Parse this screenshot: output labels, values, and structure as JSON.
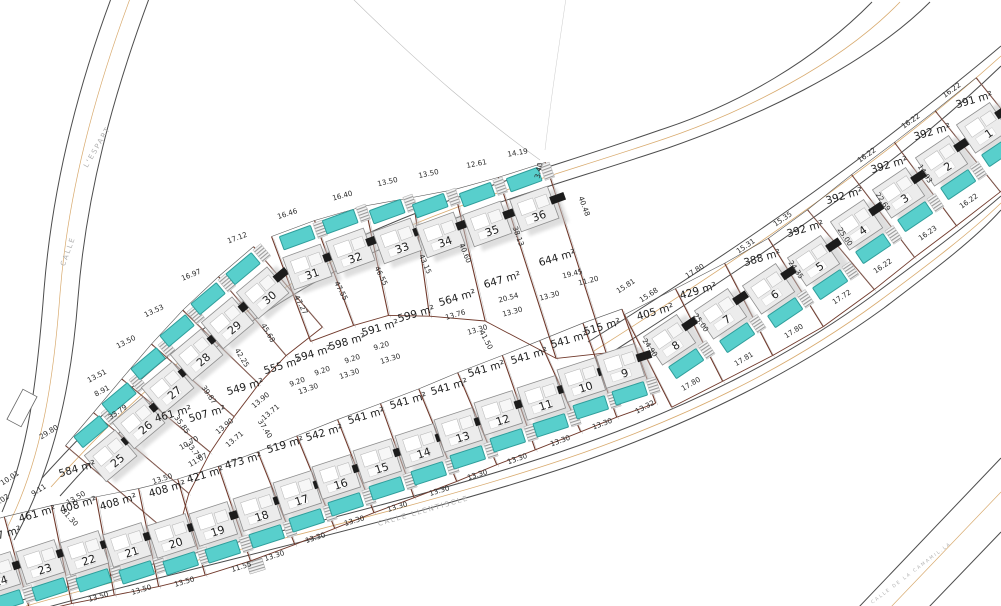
{
  "document": {
    "type": "urbanization plot site plan"
  },
  "streets": [
    {
      "id": "calle-l-espart",
      "words": [
        {
          "t": "CALLE",
          "x": 70,
          "y": 252,
          "r": -70
        },
        {
          "t": "L'ESPART",
          "x": 99,
          "y": 148,
          "r": -60
        }
      ]
    },
    {
      "id": "calle-llentiscle",
      "words": [
        {
          "t": "CALLE LLENTISCLE",
          "x": 424,
          "y": 513,
          "r": -16
        }
      ]
    },
    {
      "id": "calle-de-la-camamil-la",
      "words": [
        {
          "t": "CALLE DE LA CAMAMIL.LA",
          "x": 912,
          "y": 574,
          "r": -37
        }
      ]
    }
  ],
  "plots": [
    {
      "num": "1",
      "area": "391 m²",
      "nx": 982,
      "ny": 127,
      "ax": 975,
      "ay": 103
    },
    {
      "num": "2",
      "area": "392 m²",
      "nx": 941,
      "ny": 160,
      "ax": 933,
      "ay": 135
    },
    {
      "num": "3",
      "area": "392 m²",
      "nx": 898,
      "ny": 192,
      "ax": 890,
      "ay": 168
    },
    {
      "num": "4",
      "area": "392 m²",
      "nx": 856,
      "ny": 224,
      "ax": 845,
      "ay": 199
    },
    {
      "num": "5",
      "area": "392 m²",
      "nx": 813,
      "ny": 260,
      "ax": 806,
      "ay": 232
    },
    {
      "num": "6",
      "area": "388 m²",
      "nx": 768,
      "ny": 288,
      "ax": 763,
      "ay": 261
    },
    {
      "num": "7",
      "area": "429 m²",
      "nx": 720,
      "ny": 313,
      "ax": 699,
      "ay": 294
    },
    {
      "num": "8",
      "area": "405 m²",
      "nx": 669,
      "ny": 339,
      "ax": 656,
      "ay": 315
    },
    {
      "num": "9",
      "area": "515 m²",
      "nx": 620,
      "ny": 365,
      "ax": 603,
      "ay": 330
    },
    {
      "num": "10",
      "area": "541 m²",
      "nx": 581,
      "ny": 379,
      "ax": 570,
      "ay": 343
    },
    {
      "num": "11",
      "area": "541 m²",
      "nx": 541,
      "ny": 397,
      "ax": 530,
      "ay": 359
    },
    {
      "num": "12",
      "area": "541 m²",
      "nx": 498,
      "ny": 412,
      "ax": 487,
      "ay": 372
    },
    {
      "num": "13",
      "area": "541 m²",
      "nx": 458,
      "ny": 429,
      "ax": 450,
      "ay": 390
    },
    {
      "num": "14",
      "area": "541 m²",
      "nx": 419,
      "ny": 445,
      "ax": 409,
      "ay": 404
    },
    {
      "num": "15",
      "area": "541 m²",
      "nx": 377,
      "ny": 460,
      "ax": 367,
      "ay": 419
    },
    {
      "num": "16",
      "area": "542 m²",
      "nx": 336,
      "ny": 476,
      "ax": 325,
      "ay": 436
    },
    {
      "num": "17",
      "area": "519 m²",
      "nx": 297,
      "ny": 492,
      "ax": 286,
      "ay": 448
    },
    {
      "num": "18",
      "area": "473 m²",
      "nx": 257,
      "ny": 508,
      "ax": 244,
      "ay": 464
    },
    {
      "num": "19",
      "area": "421 m²",
      "nx": 213,
      "ny": 523,
      "ax": 206,
      "ay": 478
    },
    {
      "num": "20",
      "area": "408 m²",
      "nx": 171,
      "ny": 535,
      "ax": 168,
      "ay": 492
    },
    {
      "num": "21",
      "area": "408 m²",
      "nx": 127,
      "ny": 544,
      "ax": 119,
      "ay": 505
    },
    {
      "num": "22",
      "area": "408 m²",
      "nx": 84,
      "ny": 552,
      "ax": 79,
      "ay": 508
    },
    {
      "num": "23",
      "area": "461 m²",
      "nx": 40,
      "ny": 561,
      "ax": 38,
      "ay": 517
    },
    {
      "num": "24",
      "area": "7 m²",
      "nx": -4,
      "ny": 573,
      "ax": 10,
      "ay": 536
    },
    {
      "num": "25",
      "area": "584 m²",
      "nx": 110,
      "ny": 455,
      "ax": 78,
      "ay": 472
    },
    {
      "num": "26",
      "area": "461 m²",
      "nx": 138,
      "ny": 422,
      "ax": 174,
      "ay": 417
    },
    {
      "num": "27",
      "area": "507 m²",
      "nx": 167,
      "ny": 387,
      "ax": 208,
      "ay": 417
    },
    {
      "num": "28",
      "area": "549 m²",
      "nx": 196,
      "ny": 354,
      "ax": 246,
      "ay": 390
    },
    {
      "num": "29",
      "area": "555 m²",
      "nx": 227,
      "ny": 322,
      "ax": 283,
      "ay": 369
    },
    {
      "num": "30",
      "area": "594 m²",
      "nx": 262,
      "ny": 292,
      "ax": 314,
      "ay": 357
    },
    {
      "num": "31",
      "area": "598 m²",
      "nx": 307,
      "ny": 266,
      "ax": 348,
      "ay": 345
    },
    {
      "num": "32",
      "area": "591 m²",
      "nx": 350,
      "ny": 250,
      "ax": 381,
      "ay": 331
    },
    {
      "num": "33",
      "area": "599 m²",
      "nx": 397,
      "ny": 240,
      "ax": 417,
      "ay": 317
    },
    {
      "num": "34",
      "area": "564 m²",
      "nx": 440,
      "ny": 234,
      "ax": 458,
      "ay": 301
    },
    {
      "num": "35",
      "area": "647 m²",
      "nx": 487,
      "ny": 223,
      "ax": 503,
      "ay": 283
    },
    {
      "num": "36",
      "area": "644 m²",
      "nx": 534,
      "ny": 208,
      "ax": 558,
      "ay": 261
    }
  ],
  "dims": [
    {
      "t": "17.12",
      "x": 238,
      "y": 240,
      "r": -20
    },
    {
      "t": "16.46",
      "x": 288,
      "y": 216,
      "r": -18
    },
    {
      "t": "16.40",
      "x": 343,
      "y": 198,
      "r": -15
    },
    {
      "t": "13.50",
      "x": 388,
      "y": 184,
      "r": -13
    },
    {
      "t": "13.50",
      "x": 429,
      "y": 176,
      "r": -12
    },
    {
      "t": "12.61",
      "x": 477,
      "y": 166,
      "r": -11
    },
    {
      "t": "14.19",
      "x": 518,
      "y": 155,
      "r": -10
    },
    {
      "t": "3.40",
      "x": 541,
      "y": 171,
      "r": -78
    },
    {
      "t": "16.97",
      "x": 192,
      "y": 277,
      "r": -22
    },
    {
      "t": "13.53",
      "x": 155,
      "y": 313,
      "r": -25
    },
    {
      "t": "13.50",
      "x": 127,
      "y": 344,
      "r": -27
    },
    {
      "t": "13.51",
      "x": 98,
      "y": 378,
      "r": -28
    },
    {
      "t": "8.91",
      "x": 103,
      "y": 393,
      "r": -28
    },
    {
      "t": "33.79",
      "x": 119,
      "y": 414,
      "r": -34
    },
    {
      "t": "29.80",
      "x": 50,
      "y": 434,
      "r": -32
    },
    {
      "t": "10.01",
      "x": 11,
      "y": 480,
      "r": -33
    },
    {
      "t": "9.11",
      "x": 40,
      "y": 492,
      "r": -33
    },
    {
      "t": "9.02",
      "x": 3,
      "y": 502,
      "r": -33
    },
    {
      "t": "13.50",
      "x": 77,
      "y": 500,
      "r": -30
    },
    {
      "t": "13.50",
      "x": 163,
      "y": 481,
      "r": -18
    },
    {
      "t": "31.30",
      "x": 68,
      "y": 519,
      "r": 48
    },
    {
      "t": "11.55",
      "x": 242,
      "y": 569,
      "r": -17
    },
    {
      "t": "13.50",
      "x": 185,
      "y": 584,
      "r": -16
    },
    {
      "t": "13.50",
      "x": 142,
      "y": 592,
      "r": -16
    },
    {
      "t": "13.50",
      "x": 99,
      "y": 599,
      "r": -16
    },
    {
      "t": "47.27",
      "x": 299,
      "y": 306,
      "r": 62
    },
    {
      "t": "45.68",
      "x": 266,
      "y": 334,
      "r": 60
    },
    {
      "t": "42.25",
      "x": 240,
      "y": 359,
      "r": 58
    },
    {
      "t": "39.87",
      "x": 207,
      "y": 396,
      "r": 56
    },
    {
      "t": "35.85",
      "x": 180,
      "y": 426,
      "r": 54
    },
    {
      "t": "37.40",
      "x": 263,
      "y": 430,
      "r": 58
    },
    {
      "t": "13.90",
      "x": 262,
      "y": 402,
      "r": -40
    },
    {
      "t": "13.71",
      "x": 272,
      "y": 414,
      "r": -40
    },
    {
      "t": "13.90",
      "x": 226,
      "y": 428,
      "r": -40
    },
    {
      "t": "13.71",
      "x": 236,
      "y": 441,
      "r": -40
    },
    {
      "t": "33.79",
      "x": 192,
      "y": 452,
      "r": 52
    },
    {
      "t": "10.70",
      "x": 190,
      "y": 445,
      "r": -30
    },
    {
      "t": "11.07",
      "x": 199,
      "y": 462,
      "r": -30
    },
    {
      "t": "47.55",
      "x": 339,
      "y": 292,
      "r": 62
    },
    {
      "t": "46.55",
      "x": 379,
      "y": 277,
      "r": 64
    },
    {
      "t": "43.15",
      "x": 423,
      "y": 265,
      "r": 66
    },
    {
      "t": "40.60",
      "x": 463,
      "y": 254,
      "r": 68
    },
    {
      "t": "38.13",
      "x": 516,
      "y": 237,
      "r": 70
    },
    {
      "t": "40.48",
      "x": 582,
      "y": 207,
      "r": 70
    },
    {
      "t": "19.45",
      "x": 573,
      "y": 276,
      "r": -14
    },
    {
      "t": "11.20",
      "x": 589,
      "y": 283,
      "r": -14
    },
    {
      "t": "20.54",
      "x": 509,
      "y": 300,
      "r": -15
    },
    {
      "t": "13.76",
      "x": 456,
      "y": 317,
      "r": -16
    },
    {
      "t": "41.50",
      "x": 484,
      "y": 341,
      "r": 62
    },
    {
      "t": "13.30",
      "x": 550,
      "y": 298,
      "r": -15
    },
    {
      "t": "13.30",
      "x": 513,
      "y": 314,
      "r": -15
    },
    {
      "t": "13.30",
      "x": 478,
      "y": 332,
      "r": -16
    },
    {
      "t": "9.20",
      "x": 382,
      "y": 348,
      "r": -17
    },
    {
      "t": "9.20",
      "x": 353,
      "y": 361,
      "r": -18
    },
    {
      "t": "9.20",
      "x": 323,
      "y": 373,
      "r": -19
    },
    {
      "t": "9.20",
      "x": 298,
      "y": 384,
      "r": -20
    },
    {
      "t": "13.30",
      "x": 391,
      "y": 361,
      "r": -17
    },
    {
      "t": "13.30",
      "x": 350,
      "y": 376,
      "r": -18
    },
    {
      "t": "13.30",
      "x": 309,
      "y": 391,
      "r": -19
    },
    {
      "t": "15.81",
      "x": 627,
      "y": 288,
      "r": -33
    },
    {
      "t": "15.68",
      "x": 650,
      "y": 297,
      "r": -33
    },
    {
      "t": "13.30",
      "x": 603,
      "y": 426,
      "r": -20
    },
    {
      "t": "13.30",
      "x": 561,
      "y": 443,
      "r": -20
    },
    {
      "t": "13.30",
      "x": 518,
      "y": 461,
      "r": -19
    },
    {
      "t": "13.30",
      "x": 478,
      "y": 477,
      "r": -18
    },
    {
      "t": "13.30",
      "x": 440,
      "y": 493,
      "r": -17
    },
    {
      "t": "13.30",
      "x": 398,
      "y": 509,
      "r": -17
    },
    {
      "t": "13.30",
      "x": 355,
      "y": 523,
      "r": -17
    },
    {
      "t": "13.30",
      "x": 316,
      "y": 540,
      "r": -18
    },
    {
      "t": "13.30",
      "x": 275,
      "y": 558,
      "r": -18
    },
    {
      "t": "13.32",
      "x": 646,
      "y": 409,
      "r": -28
    },
    {
      "t": "17.80",
      "x": 692,
      "y": 386,
      "r": -30
    },
    {
      "t": "17.81",
      "x": 745,
      "y": 361,
      "r": -31
    },
    {
      "t": "17.80",
      "x": 795,
      "y": 333,
      "r": -32
    },
    {
      "t": "17.72",
      "x": 843,
      "y": 299,
      "r": -33
    },
    {
      "t": "16.22",
      "x": 884,
      "y": 268,
      "r": -34
    },
    {
      "t": "16.23",
      "x": 929,
      "y": 235,
      "r": -35
    },
    {
      "t": "16.22",
      "x": 970,
      "y": 203,
      "r": -35
    },
    {
      "t": "17.80",
      "x": 696,
      "y": 273,
      "r": -32
    },
    {
      "t": "24.90",
      "x": 648,
      "y": 349,
      "r": 55
    },
    {
      "t": "25.00",
      "x": 699,
      "y": 324,
      "r": 55
    },
    {
      "t": "24.35",
      "x": 794,
      "y": 271,
      "r": 55
    },
    {
      "t": "25.00",
      "x": 843,
      "y": 238,
      "r": 56
    },
    {
      "t": "22.69",
      "x": 881,
      "y": 203,
      "r": 56
    },
    {
      "t": "14.93",
      "x": 923,
      "y": 175,
      "r": 57
    },
    {
      "t": "15.35",
      "x": 784,
      "y": 221,
      "r": -34
    },
    {
      "t": "15.31",
      "x": 747,
      "y": 248,
      "r": -34
    },
    {
      "t": "16.22",
      "x": 868,
      "y": 157,
      "r": -35
    },
    {
      "t": "16.22",
      "x": 912,
      "y": 123,
      "r": -35
    },
    {
      "t": "16.22",
      "x": 953,
      "y": 92,
      "r": -36
    }
  ],
  "colors": {
    "pool": "#58cfcc",
    "pool_stroke": "#2f9e9b",
    "boundary": "#70392b",
    "road": "#4d4d4d",
    "curb": "#d8aa6e",
    "dim_text": "#2b2b2b",
    "area_text": "#1d1d1d",
    "street_text": "#b0b0b0",
    "house_fill": "#ececec"
  }
}
